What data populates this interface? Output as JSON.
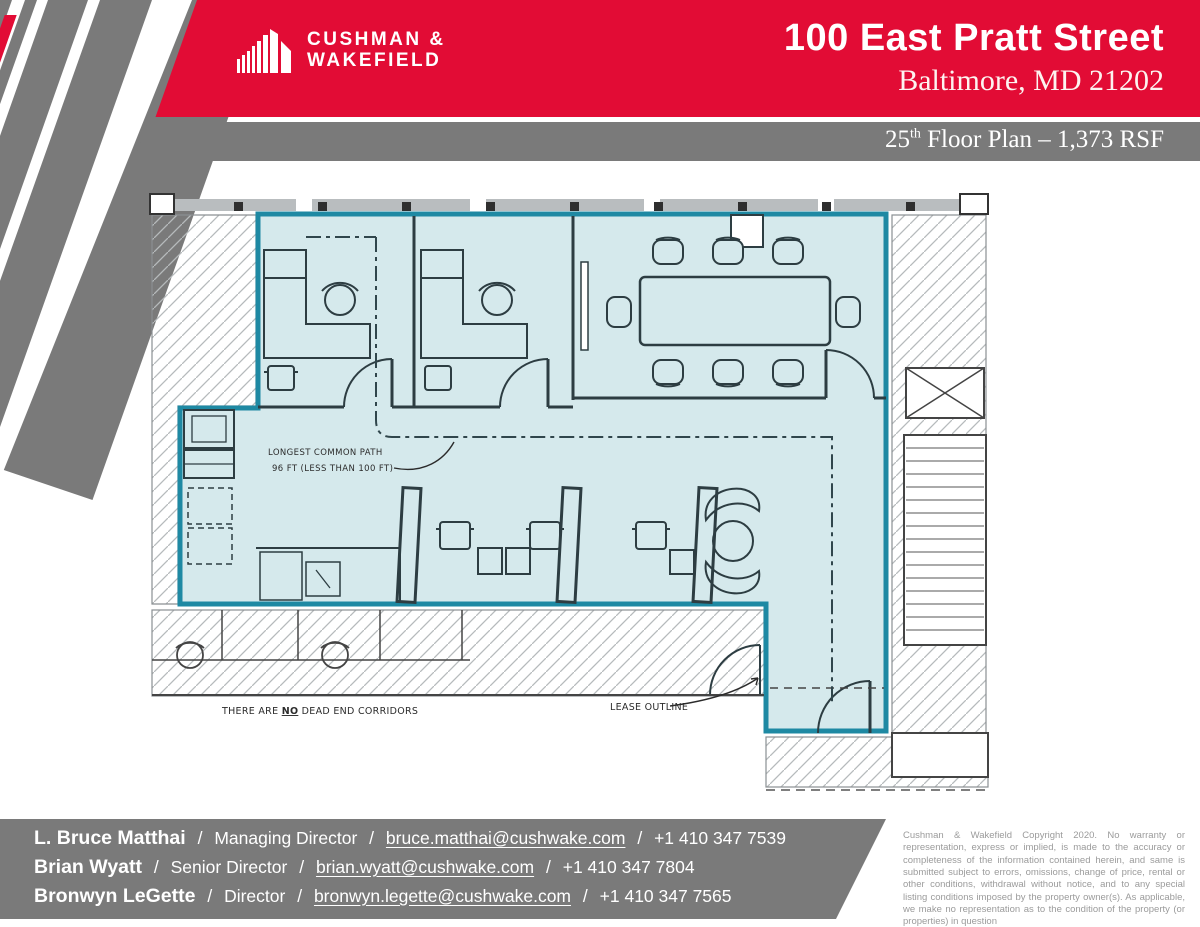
{
  "brand": {
    "logo_line1": "CUSHMAN &",
    "logo_line2": "WAKEFIELD"
  },
  "header": {
    "title": "100 East Pratt Street",
    "subtitle": "Baltimore, MD 21202"
  },
  "banner": {
    "floor_number": "25",
    "ordinal": "th",
    "rest": " Floor Plan – 1,373 RSF"
  },
  "plan": {
    "annotations": {
      "common_path_1": "LONGEST COMMON PATH",
      "common_path_2": "96 FT (LESS THAN 100 FT)",
      "dead_end_a": "THERE ARE ",
      "dead_end_b": "NO",
      "dead_end_c": " DEAD END CORRIDORS",
      "lease_label": "LEASE OUTLINE"
    },
    "colors": {
      "lease_fill": "#d5e9ec",
      "lease_stroke": "#1e89a3",
      "wall": "#2d3d42",
      "hatch": "#b6babc"
    }
  },
  "footer": {
    "separator": "/"
  },
  "contacts": [
    {
      "name": "L. Bruce Matthai",
      "title": "Managing Director",
      "email": "bruce.matthai@cushwake.com",
      "phone": "+1 410 347 7539"
    },
    {
      "name": "Brian Wyatt",
      "title": "Senior Director",
      "email": "brian.wyatt@cushwake.com",
      "phone": "+1 410 347 7804"
    },
    {
      "name": "Bronwyn LeGette",
      "title": "Director",
      "email": "bronwyn.legette@cushwake.com",
      "phone": "+1 410 347 7565"
    }
  ],
  "disclaimer": "Cushman & Wakefield Copyright 2020.  No warranty or representation, express or implied, is made to the accuracy or completeness of the information contained herein, and same is submitted subject to errors, omissions, change of price, rental or other conditions, withdrawal without notice, and to any special listing conditions imposed by the property owner(s). As applicable, we make no representation as to the condition of the property (or properties) in question",
  "theme": {
    "red": "#e20c35",
    "gray": "#7a7a7a"
  }
}
